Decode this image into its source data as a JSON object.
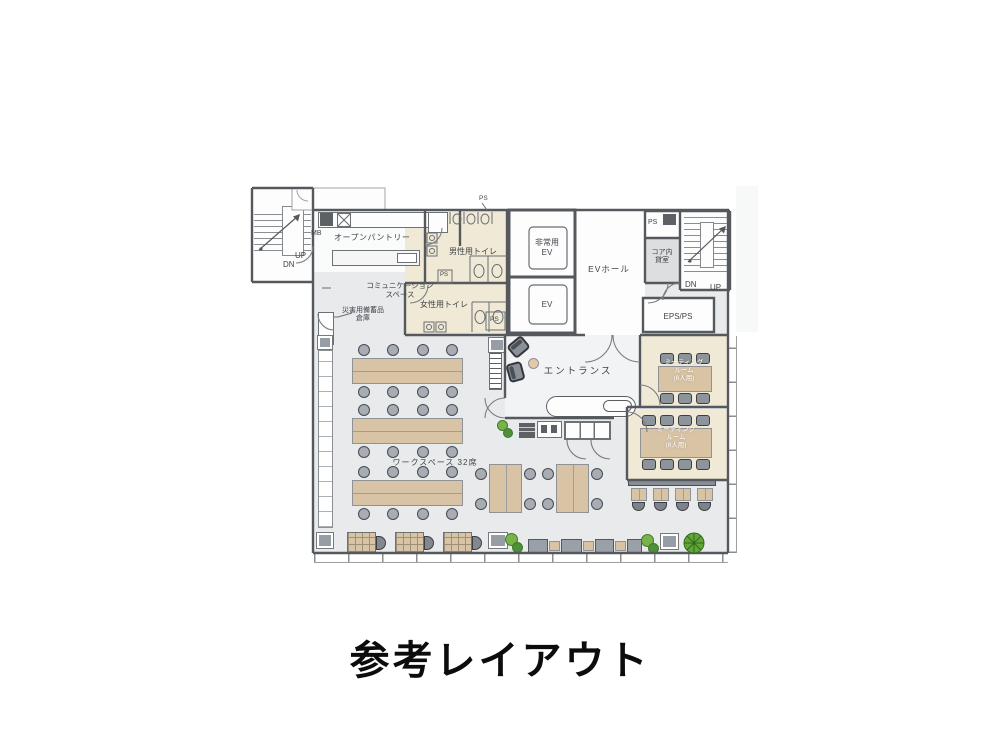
{
  "caption": "参考レイアウト",
  "plan": {
    "markers": {
      "mb": "MB",
      "ps": "PS",
      "eps_ps": "EPS/PS"
    },
    "stair_left": {
      "up": "UP",
      "dn": "DN"
    },
    "stair_right": {
      "up": "UP",
      "dn": "DN"
    },
    "rooms": {
      "open_pantry": {
        "label": "オープンパントリー"
      },
      "communication_space": {
        "line1": "コミュニケーション",
        "line2": "スペース"
      },
      "disaster_storage": {
        "line1": "災害用備蓄品",
        "line2": "倉庫"
      },
      "mens_toilet": {
        "label": "男性用トイレ"
      },
      "womens_toilet": {
        "label": "女性用トイレ"
      },
      "emergency_ev": {
        "line1": "非常用",
        "line2": "EV"
      },
      "ev": {
        "label": "EV"
      },
      "ev_hall": {
        "label": "EVホール"
      },
      "core_rental": {
        "line1": "コア内",
        "line2": "貸室"
      },
      "entrance": {
        "label": "エントランス"
      },
      "meeting_room_6": {
        "line1": "ミーティング",
        "line2": "ルーム",
        "line3": "(6人用)",
        "seats": 6
      },
      "meeting_room_8": {
        "line1": "ミーティング",
        "line2": "ルーム",
        "line3": "(8人用)",
        "seats": 8
      },
      "workspace": {
        "label": "ワークスペース 32席",
        "seats": 32
      }
    }
  },
  "colors": {
    "floor": "#e8eaec",
    "room_white": "#fdfdfd",
    "room_cream": "#efe9d6",
    "wall": "#55595e",
    "table_wood": "#d9c3a5",
    "chair_gray": "#9aa0a7",
    "core_room_fill": "#dcdee0",
    "plant_green": "#7ab24a",
    "caption_black": "#0c0c0c"
  }
}
